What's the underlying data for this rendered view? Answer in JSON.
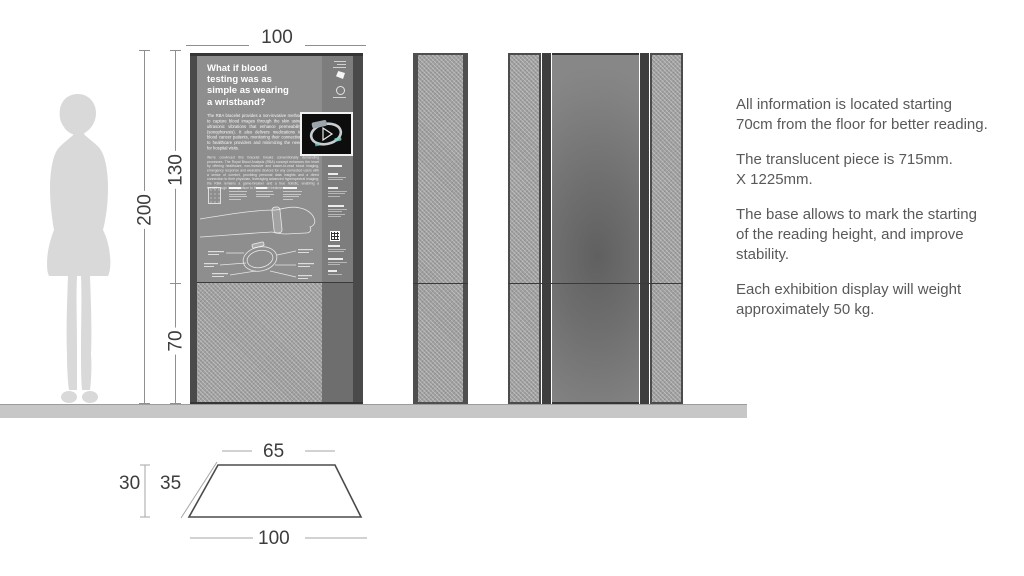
{
  "dims": {
    "width_top": "100",
    "height_total": "200",
    "height_upper": "130",
    "height_base": "70"
  },
  "plan": {
    "top": "65",
    "slant": "35",
    "depth": "30",
    "bottom": "100"
  },
  "panel": {
    "headline_lines": [
      "What if blood",
      "testing was as",
      "simple as wearing",
      "a wristband?"
    ],
    "intro": "The RBA bracelet provides a non-invasive method to capture blood images through the skin using ultrasonic vibrations that enhance permeability (sonophoresis). It also delivers medications to blood cancer patients, monitoring their connection to healthcare providers and minimizing the need for hospital visits.",
    "body": "We're convinced this bracelet breaks conventionally demanding processes. The Royal Blood Analysis (RBA) concept enhances the heart by offering healthcare, non-invasive and easier-to-read blood imaging, emergency response and wearable devices for any connected users with a sense of comfort, providing personal data insights and a direct connection to their physician, leveraging advanced hyperspectral imaging; the RBA remains a game-breaker and a true holistic, enabling a breakthrough in comparison to the cancer treatment."
  },
  "notes": {
    "p1": "All information is located starting 70cm from the floor for better reading.",
    "p2a": "The translucent piece is 715mm.",
    "p2b": " X 1225mm.",
    "p3": "The base allows to mark the starting of the reading height, and improve stability.",
    "p4": "Each exhibition display will weight approximately 50 kg."
  },
  "colors": {
    "panel_gray": "#8e8e8e",
    "edge_dark": "#4a4a4a",
    "floor_gray": "#c7c7c7",
    "text_gray": "#595959",
    "dim_text": "#3d3d3d"
  }
}
